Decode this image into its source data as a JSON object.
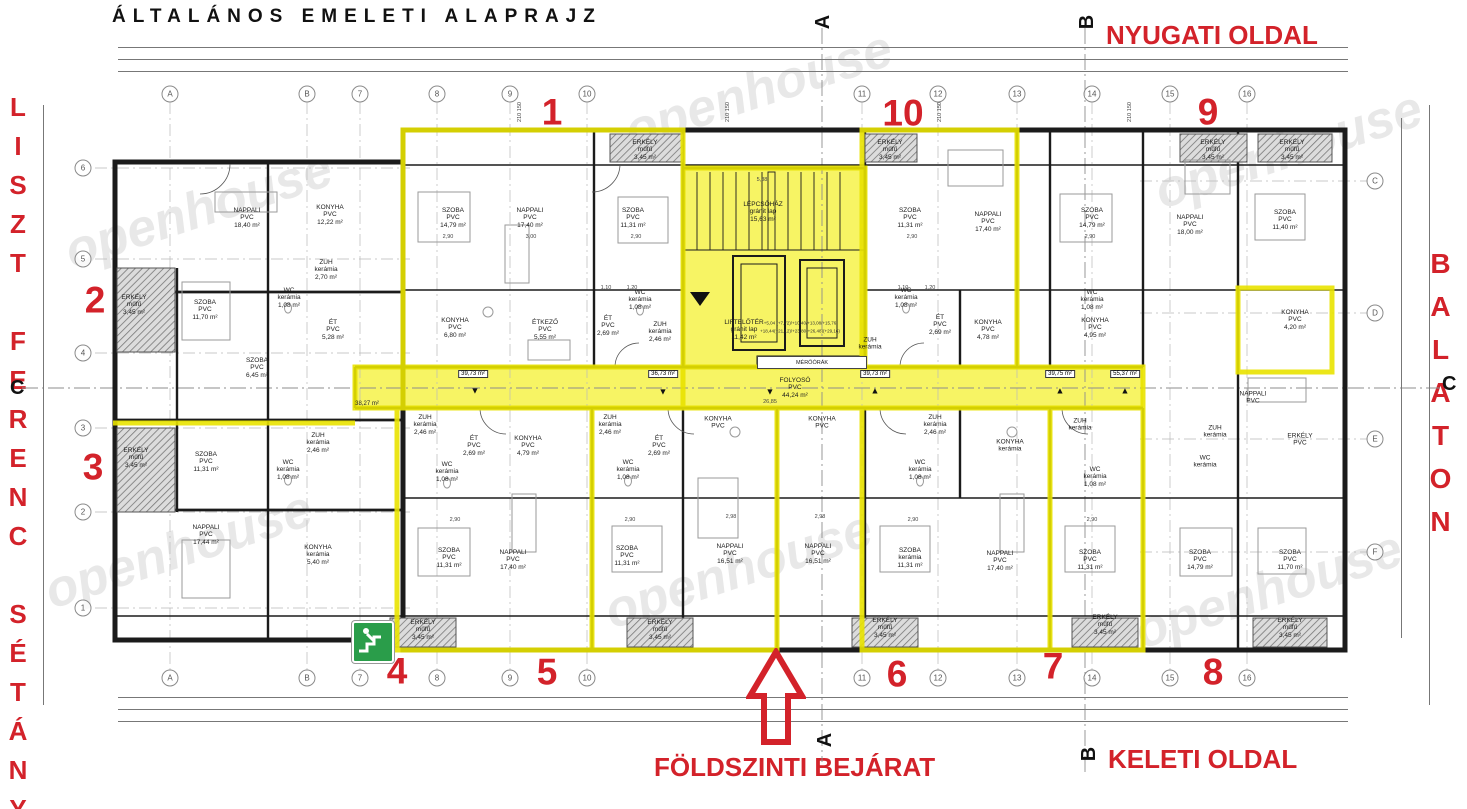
{
  "title": "ÁLTALÁNOS EMELETI ALAPRAJZ",
  "watermark": {
    "text": "openhouse"
  },
  "colors": {
    "annotation_red": "#d3222a",
    "highlight_yellow": "#f7f464",
    "highlight_outline": "#e9e300",
    "exit_green": "#2a9d4a"
  },
  "annotations": {
    "west_side": "NYUGATI OLDAL",
    "east_side": "KELETI OLDAL",
    "entrance": "FÖLDSZINTI BEJÁRAT",
    "street": "LISZT FERENC SÉTÁNY",
    "lake": "BALATON"
  },
  "apartment_numbers": [
    {
      "t": "1",
      "x": 552,
      "y": 112
    },
    {
      "t": "10",
      "x": 903,
      "y": 113
    },
    {
      "t": "9",
      "x": 1208,
      "y": 112
    },
    {
      "t": "2",
      "x": 95,
      "y": 300
    },
    {
      "t": "3",
      "x": 93,
      "y": 467
    },
    {
      "t": "4",
      "x": 397,
      "y": 671
    },
    {
      "t": "5",
      "x": 547,
      "y": 672
    },
    {
      "t": "6",
      "x": 897,
      "y": 674
    },
    {
      "t": "7",
      "x": 1053,
      "y": 666
    },
    {
      "t": "8",
      "x": 1213,
      "y": 672
    }
  ],
  "grid_bubbles": [
    {
      "t": "A",
      "x": 170,
      "y": 94
    },
    {
      "t": "B",
      "x": 307,
      "y": 94
    },
    {
      "t": "7",
      "x": 360,
      "y": 94
    },
    {
      "t": "8",
      "x": 437,
      "y": 94
    },
    {
      "t": "9",
      "x": 510,
      "y": 94
    },
    {
      "t": "10",
      "x": 587,
      "y": 94
    },
    {
      "t": "11",
      "x": 862,
      "y": 94
    },
    {
      "t": "12",
      "x": 938,
      "y": 94
    },
    {
      "t": "13",
      "x": 1017,
      "y": 94
    },
    {
      "t": "14",
      "x": 1092,
      "y": 94
    },
    {
      "t": "15",
      "x": 1170,
      "y": 94
    },
    {
      "t": "16",
      "x": 1247,
      "y": 94
    },
    {
      "t": "A",
      "x": 170,
      "y": 678
    },
    {
      "t": "B",
      "x": 307,
      "y": 678
    },
    {
      "t": "7",
      "x": 360,
      "y": 678
    },
    {
      "t": "8",
      "x": 437,
      "y": 678
    },
    {
      "t": "9",
      "x": 510,
      "y": 678
    },
    {
      "t": "10",
      "x": 587,
      "y": 678
    },
    {
      "t": "11",
      "x": 862,
      "y": 678
    },
    {
      "t": "12",
      "x": 938,
      "y": 678
    },
    {
      "t": "13",
      "x": 1017,
      "y": 678
    },
    {
      "t": "14",
      "x": 1092,
      "y": 678
    },
    {
      "t": "15",
      "x": 1170,
      "y": 678
    },
    {
      "t": "16",
      "x": 1247,
      "y": 678
    },
    {
      "t": "6",
      "x": 83,
      "y": 168
    },
    {
      "t": "5",
      "x": 83,
      "y": 259
    },
    {
      "t": "4",
      "x": 83,
      "y": 353
    },
    {
      "t": "3",
      "x": 83,
      "y": 428
    },
    {
      "t": "2",
      "x": 83,
      "y": 512
    },
    {
      "t": "1",
      "x": 83,
      "y": 608
    },
    {
      "t": "C",
      "x": 1375,
      "y": 181
    },
    {
      "t": "D",
      "x": 1375,
      "y": 313
    },
    {
      "t": "E",
      "x": 1375,
      "y": 439
    },
    {
      "t": "F",
      "x": 1375,
      "y": 552
    }
  ],
  "section_markers": [
    {
      "t": "A",
      "x": 816,
      "y": 12,
      "cls": "rot"
    },
    {
      "t": "B",
      "x": 1080,
      "y": 12,
      "cls": "rot"
    },
    {
      "t": "A",
      "x": 818,
      "y": 730,
      "cls": "rot"
    },
    {
      "t": "B",
      "x": 1082,
      "y": 744,
      "cls": "rot"
    },
    {
      "t": "C",
      "x": 10,
      "y": 378
    },
    {
      "t": "C",
      "x": 1442,
      "y": 374
    }
  ],
  "core": {
    "stair_name": "LÉPCSŐHÁZ",
    "stair_mat": "gránit lap",
    "stair_area": "15,63 m²",
    "lift_name": "LIFTELŐTÉR",
    "lift_mat": "gránit lap",
    "lift_area": "11,42 m²",
    "meters": "MÉRŐÓRÁK",
    "levels1": "+5,04 (+7,72)/+10,40/+13,08/+15,76",
    "levels2": "+18,44(+21,12)/+23,80(+26,48)(+29,16)"
  },
  "corridor": {
    "area_left": "38,27 m²",
    "boxes": [
      {
        "t": "39,73 m²",
        "x": 473,
        "y": 374
      },
      {
        "t": "36,73 m²",
        "x": 663,
        "y": 374
      },
      {
        "t": "39,73 m²",
        "x": 875,
        "y": 374
      },
      {
        "t": "39,75 m²",
        "x": 1060,
        "y": 374
      },
      {
        "t": "55,37 m²",
        "x": 1125,
        "y": 374
      }
    ],
    "arrows": [
      {
        "t": "▼",
        "x": 475,
        "y": 391
      },
      {
        "t": "▼",
        "x": 663,
        "y": 392
      },
      {
        "t": "▼",
        "x": 770,
        "y": 392
      },
      {
        "t": "▲",
        "x": 875,
        "y": 391
      },
      {
        "t": "▲",
        "x": 1060,
        "y": 391
      },
      {
        "t": "▲",
        "x": 1125,
        "y": 391
      }
    ]
  },
  "rooms": [
    {
      "n": "NAPPALI",
      "m": "PVC",
      "a": "18,40 m²",
      "x": 247,
      "y": 218
    },
    {
      "n": "KONYHA",
      "m": "PVC",
      "a": "12,22 m²",
      "x": 330,
      "y": 215
    },
    {
      "n": "ERKÉLY",
      "m": "műfű",
      "a": "3,45 m²",
      "x": 134,
      "y": 305
    },
    {
      "n": "SZOBA",
      "m": "PVC",
      "a": "11,70 m²",
      "x": 205,
      "y": 310
    },
    {
      "n": "ZUH",
      "m": "kerámia",
      "a": "2,70 m²",
      "x": 326,
      "y": 270
    },
    {
      "n": "WC",
      "m": "kerámia",
      "a": "1,08 m²",
      "x": 289,
      "y": 298
    },
    {
      "n": "ÉT",
      "m": "PVC",
      "a": "5,28 m²",
      "x": 333,
      "y": 330
    },
    {
      "n": "SZOBA",
      "m": "PVC",
      "a": "6,45 m²",
      "x": 257,
      "y": 368
    },
    {
      "n": "ERKÉLY",
      "m": "műfű",
      "a": "3,45 m²",
      "x": 136,
      "y": 458
    },
    {
      "n": "SZOBA",
      "m": "PVC",
      "a": "11,31 m²",
      "x": 206,
      "y": 462
    },
    {
      "n": "ZUH",
      "m": "kerámia",
      "a": "2,46 m²",
      "x": 318,
      "y": 443
    },
    {
      "n": "WC",
      "m": "kerámia",
      "a": "1,08 m²",
      "x": 288,
      "y": 470
    },
    {
      "n": "NAPPALI",
      "m": "PVC",
      "a": "17,44 m²",
      "x": 206,
      "y": 535
    },
    {
      "n": "KONYHA",
      "m": "kerámia",
      "a": "5,40 m²",
      "x": 318,
      "y": 555
    },
    {
      "n": "SZOBA",
      "m": "PVC",
      "a": "14,79 m²",
      "x": 453,
      "y": 218
    },
    {
      "n": "NAPPALI",
      "m": "PVC",
      "a": "17,40 m²",
      "x": 530,
      "y": 218
    },
    {
      "n": "SZOBA",
      "m": "PVC",
      "a": "11,31 m²",
      "x": 633,
      "y": 218
    },
    {
      "n": "ERKÉLY",
      "m": "műfű",
      "a": "3,45 m²",
      "x": 645,
      "y": 150
    },
    {
      "n": "KONYHA",
      "m": "PVC",
      "a": "6,80 m²",
      "x": 455,
      "y": 328
    },
    {
      "n": "ÉTKEZŐ",
      "m": "PVC",
      "a": "5,55 m²",
      "x": 545,
      "y": 330
    },
    {
      "n": "ÉT",
      "m": "PVC",
      "a": "2,69 m²",
      "x": 608,
      "y": 326
    },
    {
      "n": "WC",
      "m": "kerámia",
      "a": "1,08 m²",
      "x": 640,
      "y": 300
    },
    {
      "n": "ZUH",
      "m": "kerámia",
      "a": "2,46 m²",
      "x": 660,
      "y": 332
    },
    {
      "n": "LÉPCSŐHÁZ",
      "m": "gránit lap",
      "a": "15,63 m²",
      "x": 763,
      "y": 212
    },
    {
      "n": "LIFTELŐTÉR",
      "m": "gránit lap",
      "a": "11,42 m²",
      "x": 744,
      "y": 330
    },
    {
      "n": "FOLYOSÓ",
      "m": "PVC",
      "a": "44,24 m²",
      "x": 795,
      "y": 388
    },
    {
      "n": "ERKÉLY",
      "m": "műfű",
      "a": "3,45 m²",
      "x": 890,
      "y": 150
    },
    {
      "n": "SZOBA",
      "m": "PVC",
      "a": "11,31 m²",
      "x": 910,
      "y": 218
    },
    {
      "n": "NAPPALI",
      "m": "PVC",
      "a": "17,40 m²",
      "x": 988,
      "y": 222
    },
    {
      "n": "WC",
      "m": "kerámia",
      "a": "1,08 m²",
      "x": 906,
      "y": 298
    },
    {
      "n": "ÉT",
      "m": "PVC",
      "a": "2,69 m²",
      "x": 940,
      "y": 325
    },
    {
      "n": "KONYHA",
      "m": "PVC",
      "a": "4,78 m²",
      "x": 988,
      "y": 330
    },
    {
      "n": "ZUH",
      "m": "kerámia",
      "a": "",
      "x": 870,
      "y": 344
    },
    {
      "n": "SZOBA",
      "m": "PVC",
      "a": "14,79 m²",
      "x": 1092,
      "y": 218
    },
    {
      "n": "ERKÉLY",
      "m": "műfű",
      "a": "3,45 m²",
      "x": 1213,
      "y": 150
    },
    {
      "n": "ERKÉLY",
      "m": "műfű",
      "a": "3,45 m²",
      "x": 1292,
      "y": 150
    },
    {
      "n": "NAPPALI",
      "m": "PVC",
      "a": "18,00 m²",
      "x": 1190,
      "y": 225
    },
    {
      "n": "SZOBA",
      "m": "PVC",
      "a": "11,40 m²",
      "x": 1285,
      "y": 220
    },
    {
      "n": "KONYHA",
      "m": "PVC",
      "a": "4,95 m²",
      "x": 1095,
      "y": 328
    },
    {
      "n": "WC",
      "m": "kerámia",
      "a": "1,08 m²",
      "x": 1092,
      "y": 300
    },
    {
      "n": "KONYHA",
      "m": "PVC",
      "a": "4,20 m²",
      "x": 1295,
      "y": 320
    },
    {
      "n": "NAPPALI",
      "m": "PVC",
      "a": "",
      "x": 1253,
      "y": 398
    },
    {
      "n": "ERKÉLY",
      "m": "PVC",
      "a": "",
      "x": 1300,
      "y": 440
    },
    {
      "n": "ZUH",
      "m": "kerámia",
      "a": "2,46 m²",
      "x": 425,
      "y": 425
    },
    {
      "n": "ÉT",
      "m": "PVC",
      "a": "2,69 m²",
      "x": 474,
      "y": 446
    },
    {
      "n": "KONYHA",
      "m": "PVC",
      "a": "4,79 m²",
      "x": 528,
      "y": 446
    },
    {
      "n": "WC",
      "m": "kerámia",
      "a": "1,08 m²",
      "x": 447,
      "y": 472
    },
    {
      "n": "SZOBA",
      "m": "PVC",
      "a": "11,31 m²",
      "x": 449,
      "y": 558
    },
    {
      "n": "NAPPALI",
      "m": "PVC",
      "a": "17,40 m²",
      "x": 513,
      "y": 560
    },
    {
      "n": "ERKÉLY",
      "m": "műfű",
      "a": "3,45 m²",
      "x": 423,
      "y": 630
    },
    {
      "n": "ZUH",
      "m": "kerámia",
      "a": "2,46 m²",
      "x": 610,
      "y": 425
    },
    {
      "n": "ÉT",
      "m": "PVC",
      "a": "2,69 m²",
      "x": 659,
      "y": 446
    },
    {
      "n": "WC",
      "m": "kerámia",
      "a": "1,08 m²",
      "x": 628,
      "y": 470
    },
    {
      "n": "SZOBA",
      "m": "PVC",
      "a": "11,31 m²",
      "x": 627,
      "y": 556
    },
    {
      "n": "KONYHA",
      "m": "PVC",
      "a": "",
      "x": 718,
      "y": 423
    },
    {
      "n": "NAPPALI",
      "m": "PVC",
      "a": "16,51 m²",
      "x": 730,
      "y": 554
    },
    {
      "n": "ERKÉLY",
      "m": "műfű",
      "a": "3,45 m²",
      "x": 660,
      "y": 630
    },
    {
      "n": "KONYHA",
      "m": "PVC",
      "a": "",
      "x": 822,
      "y": 423
    },
    {
      "n": "NAPPALI",
      "m": "PVC",
      "a": "16,51 m²",
      "x": 818,
      "y": 554
    },
    {
      "n": "ZUH",
      "m": "kerámia",
      "a": "2,46 m²",
      "x": 935,
      "y": 425
    },
    {
      "n": "WC",
      "m": "kerámia",
      "a": "1,08 m²",
      "x": 920,
      "y": 470
    },
    {
      "n": "SZOBA",
      "m": "kerámia",
      "a": "11,31 m²",
      "x": 910,
      "y": 558
    },
    {
      "n": "NAPPALI",
      "m": "PVC",
      "a": "17,40 m²",
      "x": 1000,
      "y": 561
    },
    {
      "n": "ERKÉLY",
      "m": "műfű",
      "a": "3,45 m²",
      "x": 885,
      "y": 628
    },
    {
      "n": "KONYHA",
      "m": "kerámia",
      "a": "",
      "x": 1010,
      "y": 446
    },
    {
      "n": "ZUH",
      "m": "kerámia",
      "a": "",
      "x": 1080,
      "y": 425
    },
    {
      "n": "WC",
      "m": "kerámia",
      "a": "1,08 m²",
      "x": 1095,
      "y": 477
    },
    {
      "n": "SZOBA",
      "m": "PVC",
      "a": "11,31 m²",
      "x": 1090,
      "y": 560
    },
    {
      "n": "ERKÉLY",
      "m": "műfű",
      "a": "3,45 m²",
      "x": 1105,
      "y": 625
    },
    {
      "n": "ZUH",
      "m": "kerámia",
      "a": "",
      "x": 1215,
      "y": 432
    },
    {
      "n": "WC",
      "m": "kerámia",
      "a": "",
      "x": 1205,
      "y": 462
    },
    {
      "n": "SZOBA",
      "m": "PVC",
      "a": "14,79 m²",
      "x": 1200,
      "y": 560
    },
    {
      "n": "SZOBA",
      "m": "PVC",
      "a": "11,70 m²",
      "x": 1290,
      "y": 560
    },
    {
      "n": "ERKÉLY",
      "m": "műfű",
      "a": "3,45 m²",
      "x": 1290,
      "y": 628
    }
  ],
  "interior_dims": [
    {
      "t": "2,90",
      "x": 448,
      "y": 237
    },
    {
      "t": "3,00",
      "x": 531,
      "y": 237
    },
    {
      "t": "2,90",
      "x": 636,
      "y": 237
    },
    {
      "t": "2,90",
      "x": 912,
      "y": 237
    },
    {
      "t": "2,90",
      "x": 1090,
      "y": 237
    },
    {
      "t": "2,98",
      "x": 731,
      "y": 517
    },
    {
      "t": "2,98",
      "x": 820,
      "y": 517
    },
    {
      "t": "2,90",
      "x": 455,
      "y": 520
    },
    {
      "t": "2,90",
      "x": 630,
      "y": 520
    },
    {
      "t": "2,90",
      "x": 913,
      "y": 520
    },
    {
      "t": "2,90",
      "x": 1092,
      "y": 520
    },
    {
      "t": "26,85",
      "x": 770,
      "y": 402
    },
    {
      "t": "5,88",
      "x": 762,
      "y": 180
    },
    {
      "t": "210 150",
      "x": 520,
      "y": 112,
      "cls": "rot"
    },
    {
      "t": "210 150",
      "x": 728,
      "y": 112,
      "cls": "rot"
    },
    {
      "t": "210 150",
      "x": 940,
      "y": 112,
      "cls": "rot"
    },
    {
      "t": "210 150",
      "x": 1130,
      "y": 112,
      "cls": "rot"
    },
    {
      "t": "1,10",
      "x": 606,
      "y": 288
    },
    {
      "t": "1,20",
      "x": 632,
      "y": 288
    },
    {
      "t": "1,10",
      "x": 903,
      "y": 288
    },
    {
      "t": "1,20",
      "x": 930,
      "y": 288
    }
  ],
  "dims": {
    "top1": [
      "1,20",
      "7,02",
      "1,48",
      "6,65",
      "41,60",
      "3,5",
      "3,00",
      "3,20"
    ],
    "top2": [
      "15",
      "1,05",
      "6,60",
      "1,90",
      "15",
      "2,90",
      "15",
      "3,00",
      "5,85",
      "3,15",
      "3,00",
      "15",
      "3,00",
      "9,00",
      "15",
      "3,20"
    ],
    "top3": [
      "8,70",
      "2,85",
      "2,95",
      "2,80",
      "10,25",
      "2,88",
      "3,00",
      "6,15",
      "2,90",
      "2,25"
    ],
    "bottom1": [
      "8,70",
      "3,10",
      "2,75",
      "2,83",
      "3,75",
      "2,60",
      "3,15",
      "2,81",
      "3,13",
      "3,17",
      "2,77",
      "2,25"
    ],
    "bottom2": [
      "6,60",
      "1,65",
      "3,00",
      "15",
      "3,00",
      "2,98",
      "15",
      "2,98",
      "3,00",
      "15",
      "3,00",
      "3,00",
      "15",
      "3,20"
    ],
    "bottom3": [
      "7,02",
      "1,53",
      "3,00",
      "3,60",
      "2,70",
      "41,60",
      "3,60",
      "3,20"
    ],
    "left": [
      "1,00",
      "3,46",
      "2,90",
      "3,00",
      "2,38",
      "2,40",
      "3,02",
      "3,00",
      "3,48",
      "2,90",
      "1,20"
    ],
    "right_inner": [
      "65",
      "1,05",
      "3,80",
      "20",
      "6,70",
      "10",
      "3,90",
      "15",
      "1,06"
    ],
    "right_outer": [
      "1,20",
      "8,08",
      "6,30",
      "13,70",
      "15,30",
      "8,03",
      "1,20"
    ]
  },
  "watermarks": [
    {
      "x": 60,
      "y": 180
    },
    {
      "x": 620,
      "y": 60
    },
    {
      "x": 1150,
      "y": 120
    },
    {
      "x": 40,
      "y": 520
    },
    {
      "x": 600,
      "y": 540
    },
    {
      "x": 1130,
      "y": 560
    }
  ]
}
